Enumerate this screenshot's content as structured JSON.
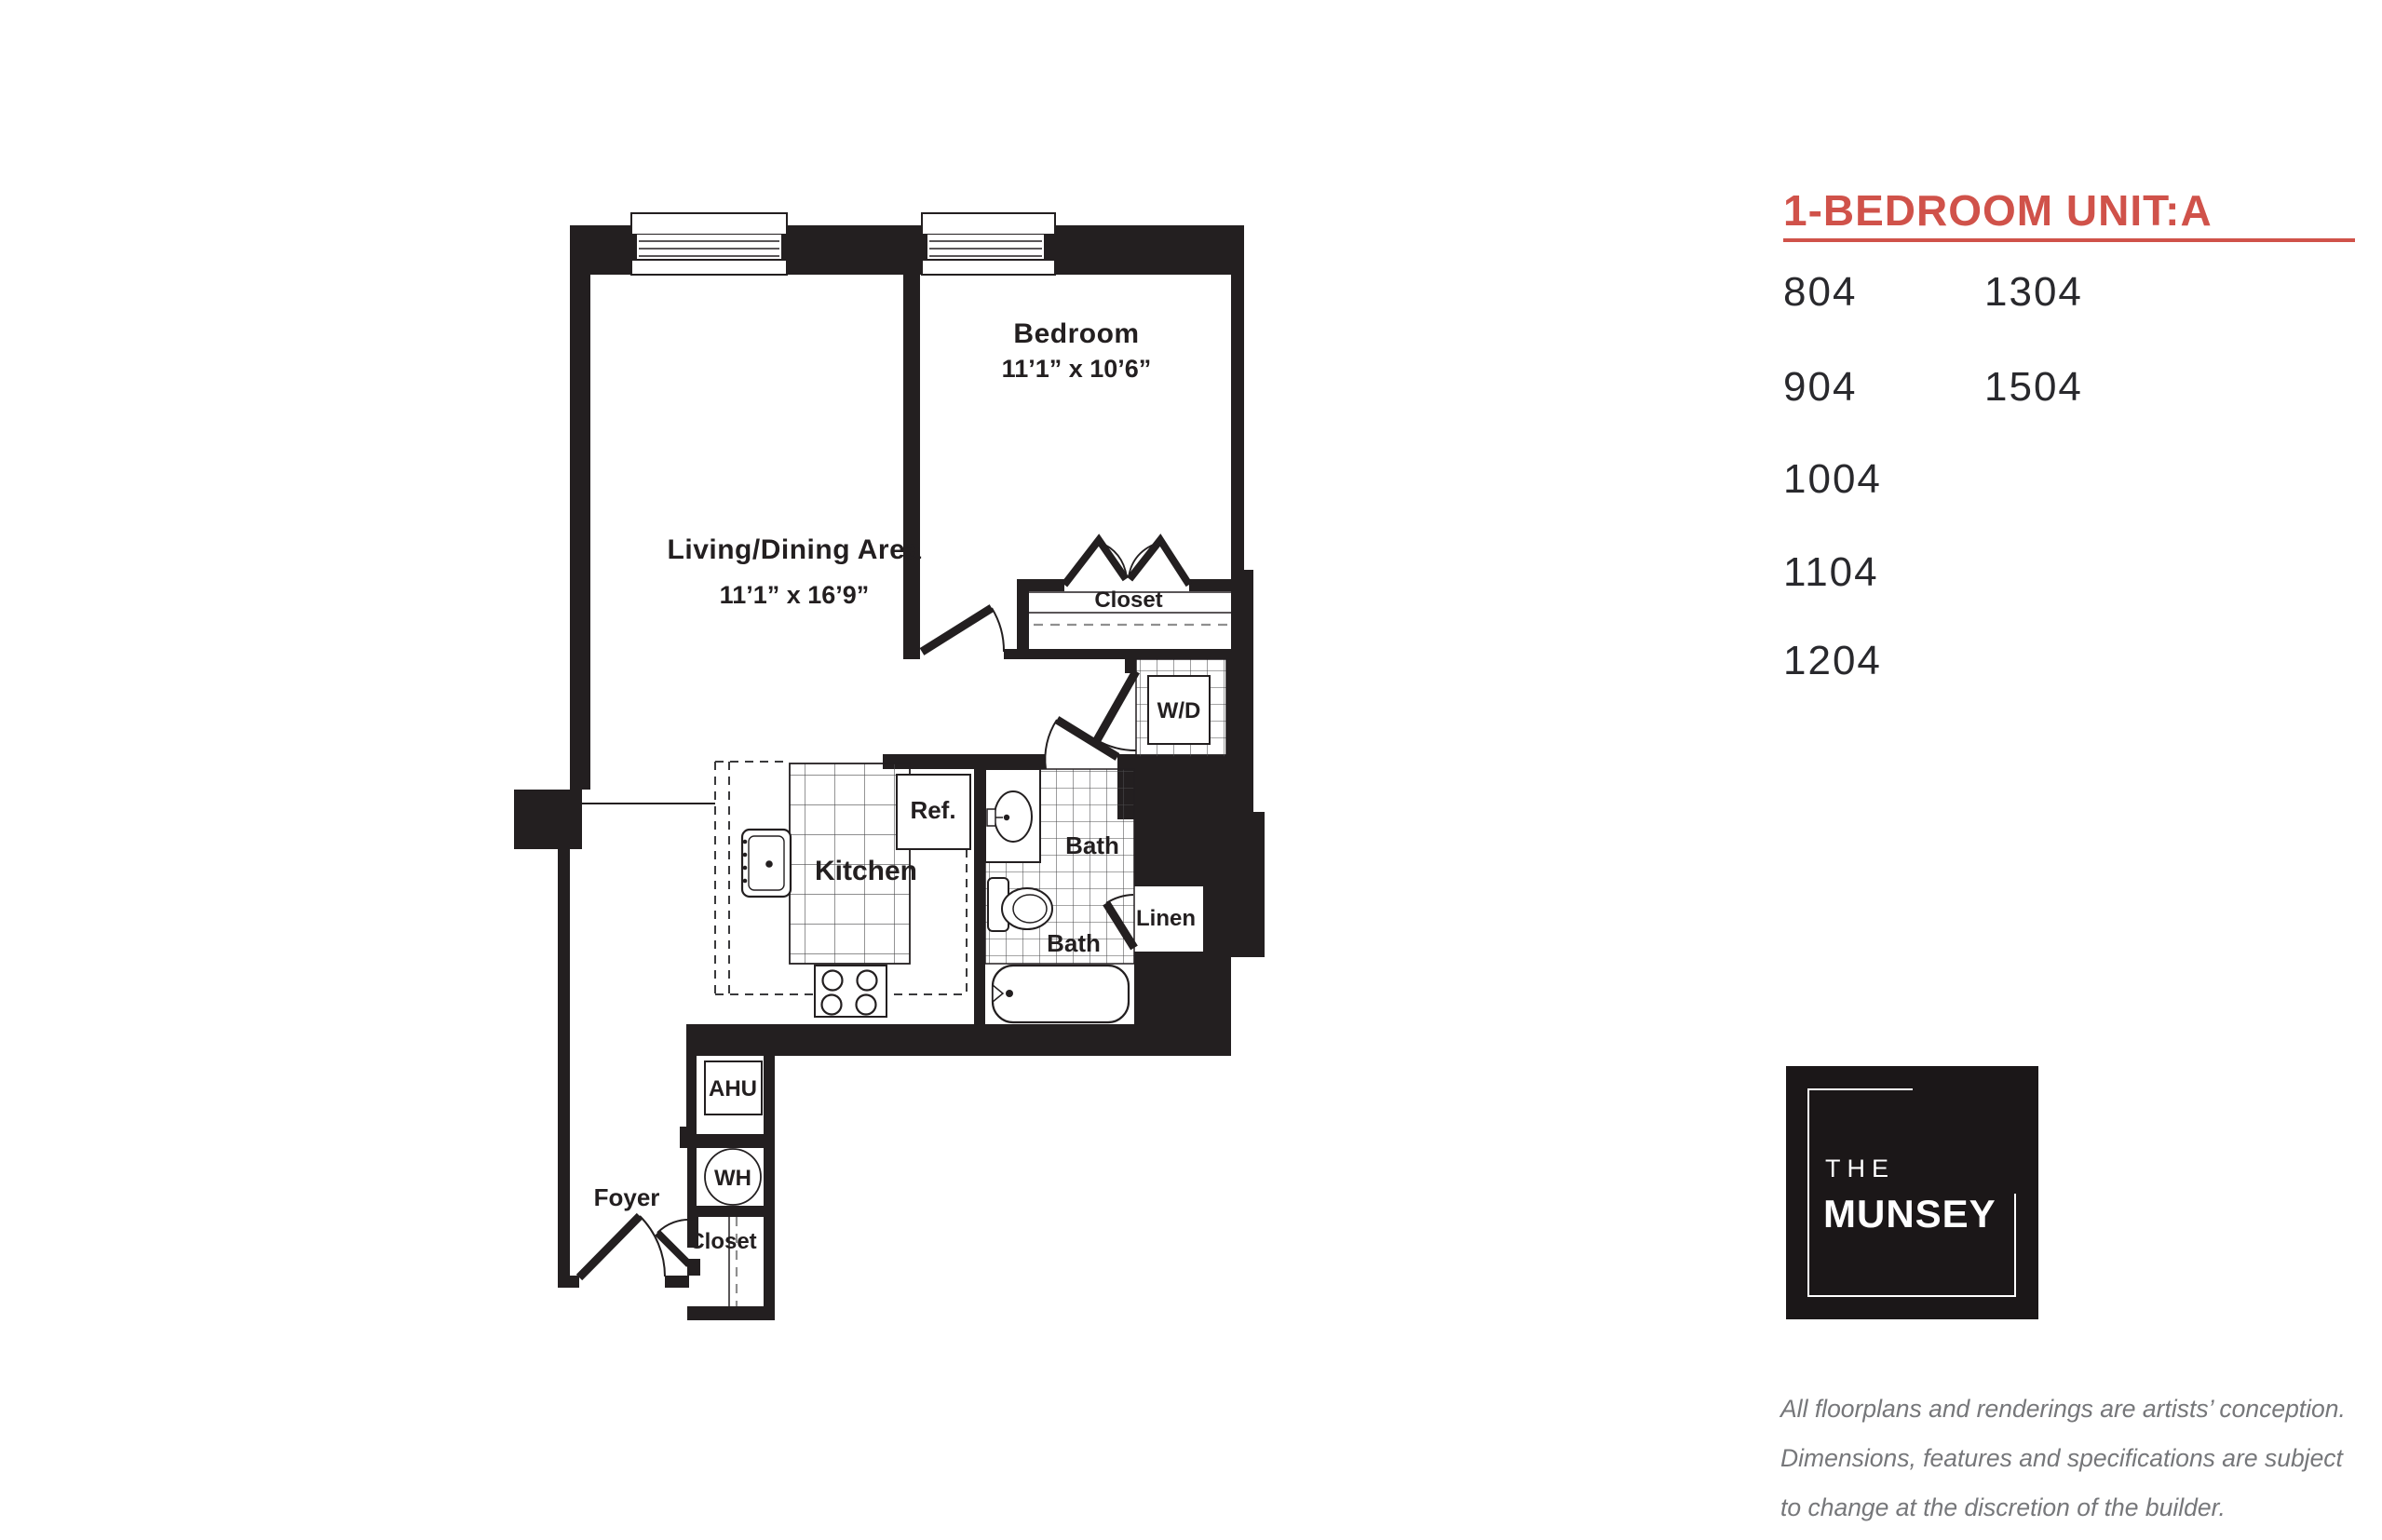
{
  "panel": {
    "title": "1-BEDROOM UNIT:A",
    "accent_color": "#d0524a",
    "unit_numbers": {
      "col1": [
        "804",
        "904",
        "1004",
        "1104",
        "1204"
      ],
      "col2": [
        "1304",
        "1504"
      ]
    },
    "logo": {
      "the": "THE",
      "munsey": "MUNSEY"
    },
    "disclaimer": {
      "line1": "All floorplans and renderings are artists’ conception.",
      "line2": "Dimensions, features and specifications are subject",
      "line3": "to change at the discretion of the builder."
    }
  },
  "floorplan": {
    "living": {
      "label": "Living/Dining Area",
      "dims": "11’1” x 16’9”"
    },
    "bedroom": {
      "label": "Bedroom",
      "dims": "11’1” x 10’6”"
    },
    "kitchen": {
      "label": "Kitchen"
    },
    "ref": {
      "label": "Ref."
    },
    "bath_upper": {
      "label": "Bath"
    },
    "bath_lower": {
      "label": "Bath"
    },
    "linen": {
      "label": "Linen"
    },
    "wd": {
      "label": "W/D"
    },
    "bedroom_closet": {
      "label": "Closet"
    },
    "ahu": {
      "label": "AHU"
    },
    "wh": {
      "label": "WH"
    },
    "foyer_closet": {
      "label": "Closet"
    },
    "foyer": {
      "label": "Foyer"
    }
  }
}
